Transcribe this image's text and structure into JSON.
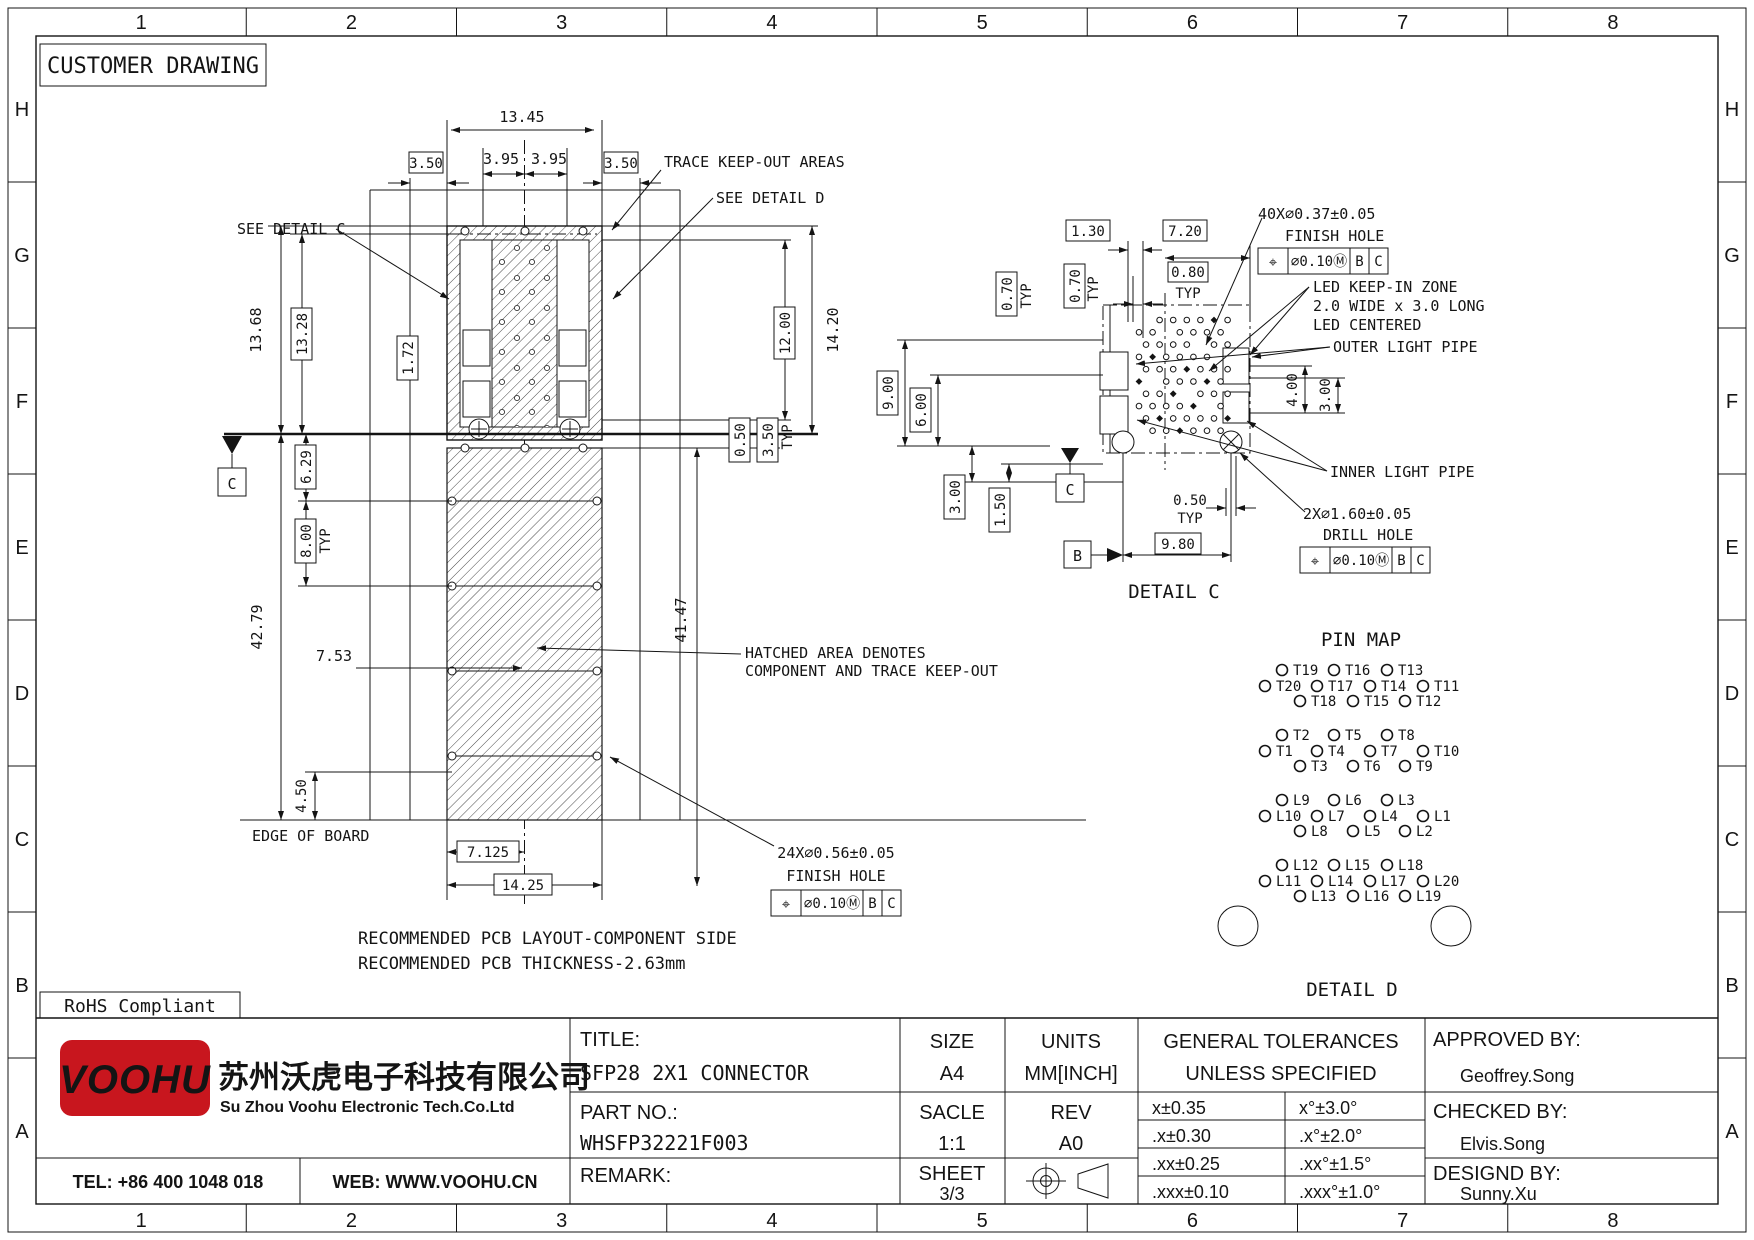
{
  "page": {
    "customer_drawing": "CUSTOMER DRAWING",
    "rohs": "RoHS Compliant"
  },
  "border": {
    "columns": [
      "1",
      "2",
      "3",
      "4",
      "5",
      "6",
      "7",
      "8"
    ],
    "rows": [
      "H",
      "G",
      "F",
      "E",
      "D",
      "C",
      "B",
      "A"
    ]
  },
  "main": {
    "dims": {
      "d13_45": "13.45",
      "d3_95": "3.95",
      "d3_50": "3.50",
      "d13_68": "13.68",
      "d13_28": "13.28",
      "d1_72": "1.72",
      "d12_00": "12.00",
      "d14_20": "14.20",
      "d6_29": "6.29",
      "d8_00": "8.00",
      "typ": "TYP",
      "d42_79": "42.79",
      "d7_53": "7.53",
      "d41_47": "41.47",
      "d0_50": "0.50",
      "d3_50b": "3.50",
      "d4_50": "4.50",
      "d7_125": "7.125",
      "d14_25": "14.25"
    },
    "notes": {
      "trace_keepout": "TRACE KEEP-OUT AREAS",
      "see_detail_c": "SEE DETAIL C",
      "see_detail_d": "SEE DETAIL D",
      "hatched_1": "HATCHED AREA DENOTES",
      "hatched_2": "COMPONENT AND TRACE KEEP-OUT",
      "edge_of_board": "EDGE OF BOARD",
      "recommended_1": "RECOMMENDED PCB LAYOUT-COMPONENT SIDE",
      "recommended_2": "RECOMMENDED PCB THICKNESS-2.63mm"
    },
    "datum_c": "C",
    "finish_hole": {
      "qty": "24X∅0.56±0.05",
      "label": "FINISH HOLE",
      "fcf": {
        "sym": "⌖",
        "tol": "∅0.10Ⓜ",
        "ref1": "B",
        "ref2": "C"
      }
    }
  },
  "detail_c": {
    "title": "DETAIL C",
    "datum_b": "B",
    "datum_c": "C",
    "dims": {
      "d1_30": "1.30",
      "d7_20": "7.20",
      "d0_80": "0.80",
      "d0_70": "0.70",
      "typ": "TYP",
      "d9_00": "9.00",
      "d6_00": "6.00",
      "d3_00": "3.00",
      "d1_50": "1.50",
      "d0_50": "0.50",
      "d9_80": "9.80",
      "d4_00": "4.00",
      "d3_00b": "3.00"
    },
    "finish_hole": {
      "qty": "40X∅0.37±0.05",
      "label": "FINISH HOLE",
      "fcf": {
        "sym": "⌖",
        "tol": "∅0.10Ⓜ",
        "ref1": "B",
        "ref2": "C"
      }
    },
    "drill_hole": {
      "qty": "2X∅1.60±0.05",
      "label": "DRILL HOLE",
      "fcf": {
        "sym": "⌖",
        "tol": "∅0.10Ⓜ",
        "ref1": "B",
        "ref2": "C"
      }
    },
    "led_1": "LED KEEP-IN ZONE",
    "led_2": "2.0 WIDE x 3.0 LONG",
    "led_3": "LED CENTERED",
    "outer_pipe": "OUTER LIGHT PIPE",
    "inner_pipe": "INNER LIGHT PIPE"
  },
  "pin_map": {
    "title": "PIN MAP",
    "detail_d_title": "DETAIL D",
    "groups": [
      {
        "rows": [
          [
            "T19",
            "T16",
            "T13"
          ],
          [
            "T20",
            "T17",
            "T14",
            "T11"
          ],
          [
            "T18",
            "T15",
            "T12"
          ]
        ]
      },
      {
        "rows": [
          [
            "T2",
            "T5",
            "T8"
          ],
          [
            "T1",
            "T4",
            "T7",
            "T10"
          ],
          [
            "T3",
            "T6",
            "T9"
          ]
        ]
      },
      {
        "rows": [
          [
            "L9",
            "L6",
            "L3"
          ],
          [
            "L10",
            "L7",
            "L4",
            "L1"
          ],
          [
            "L8",
            "L5",
            "L2"
          ]
        ]
      },
      {
        "rows": [
          [
            "L12",
            "L15",
            "L18"
          ],
          [
            "L11",
            "L14",
            "L17",
            "L20"
          ],
          [
            "L13",
            "L16",
            "L19"
          ]
        ]
      }
    ]
  },
  "title_block": {
    "company": {
      "logo": "VOOHU",
      "name_cn": "苏州沃虎电子科技有限公司",
      "name_en": "Su Zhou Voohu Electronic Tech.Co.Ltd",
      "tel": "TEL: +86 400 1048 018",
      "web": "WEB: WWW.VOOHU.CN",
      "brand_red": "#c8161e",
      "web_blue": "#1f4e79"
    },
    "fields": {
      "title_label": "TITLE:",
      "title_value": "SFP28 2X1 CONNECTOR",
      "part_label": "PART NO.:",
      "part_value": "WHSFP32221F003",
      "remark_label": "REMARK:",
      "size_label": "SIZE",
      "size_value": "A4",
      "units_label": "UNITS",
      "units_value": "MM[INCH]",
      "scale_label": "SACLE",
      "scale_value": "1:1",
      "rev_label": "REV",
      "rev_value": "A0",
      "sheet_label": "SHEET",
      "sheet_value": "3/3",
      "approved_label": "APPROVED BY:",
      "approved_value": "Geoffrey.Song",
      "checked_label": "CHECKED BY:",
      "checked_value": "Elvis.Song",
      "designed_label": "DESIGND BY:",
      "designed_value": "Sunny.Xu"
    },
    "tolerances": {
      "header_1": "GENERAL TOLERANCES",
      "header_2": "UNLESS SPECIFIED",
      "rows": [
        [
          "x±0.35",
          "x°±3.0°"
        ],
        [
          ".x±0.30",
          ".x°±2.0°"
        ],
        [
          ".xx±0.25",
          ".xx°±1.5°"
        ],
        [
          ".xxx±0.10",
          ".xxx°±1.0°"
        ]
      ]
    }
  }
}
